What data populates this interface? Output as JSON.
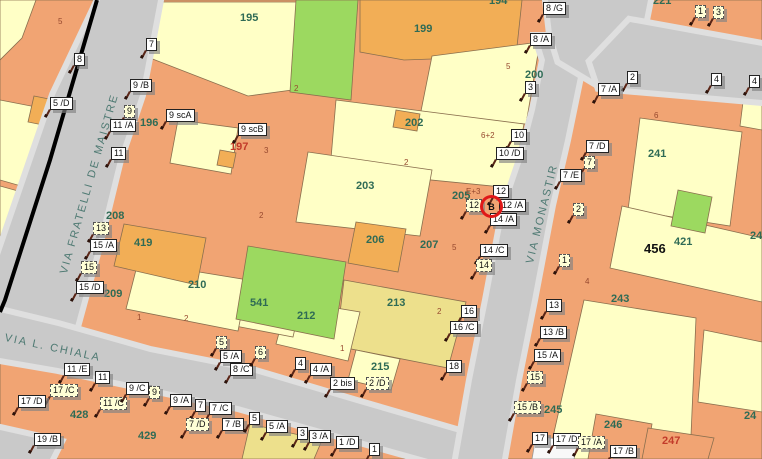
{
  "palette": {
    "parcel_salmon": "#F1A473",
    "parcel_pale_yellow": "#FFFFC6",
    "parcel_khaki": "#EDE08C",
    "parcel_green": "#9CD960",
    "building_orange": "#F2AE56",
    "road_gray": "#C9C9C9",
    "sidewalk_gray": "#E2E2E2",
    "parcel_number_green": "#2F6B55",
    "parcel_number_red": "#C23B2A",
    "annotation_brown": "#96482E",
    "street_name_color": "#4F7A73",
    "selection_red": "#E01818",
    "boundary_black": "#000000"
  },
  "streets": [
    {
      "name": "VIA FRATELLI DE MAISTRE"
    },
    {
      "name": "VIA L. CHIALA"
    },
    {
      "name": "VIA MONASTIR"
    }
  ],
  "selection": {
    "label": "B",
    "x": 480,
    "y": 195
  },
  "parcel_numbers": [
    {
      "n": "195",
      "x": 240,
      "y": 12
    },
    {
      "n": "194",
      "x": 489,
      "y": -5
    },
    {
      "n": "196",
      "x": 140,
      "y": 117
    },
    {
      "n": "197",
      "x": 230,
      "y": 141,
      "c": "red"
    },
    {
      "n": "199",
      "x": 414,
      "y": 23
    },
    {
      "n": "200",
      "x": 525,
      "y": 69
    },
    {
      "n": "202",
      "x": 405,
      "y": 117
    },
    {
      "n": "203",
      "x": 356,
      "y": 180
    },
    {
      "n": "205",
      "x": 452,
      "y": 190
    },
    {
      "n": "206",
      "x": 366,
      "y": 234
    },
    {
      "n": "207",
      "x": 420,
      "y": 239
    },
    {
      "n": "208",
      "x": 106,
      "y": 210
    },
    {
      "n": "209",
      "x": 104,
      "y": 288
    },
    {
      "n": "210",
      "x": 188,
      "y": 279
    },
    {
      "n": "212",
      "x": 297,
      "y": 310
    },
    {
      "n": "213",
      "x": 387,
      "y": 297
    },
    {
      "n": "215",
      "x": 371,
      "y": 361
    },
    {
      "n": "221",
      "x": 653,
      "y": -5
    },
    {
      "n": "241",
      "x": 648,
      "y": 148
    },
    {
      "n": "243",
      "x": 611,
      "y": 293
    },
    {
      "n": "245",
      "x": 544,
      "y": 404
    },
    {
      "n": "246",
      "x": 604,
      "y": 419
    },
    {
      "n": "247",
      "x": 662,
      "y": 435,
      "c": "red"
    },
    {
      "n": "419",
      "x": 134,
      "y": 237
    },
    {
      "n": "421",
      "x": 674,
      "y": 236
    },
    {
      "n": "428",
      "x": 70,
      "y": 409
    },
    {
      "n": "429",
      "x": 138,
      "y": 430
    },
    {
      "n": "456",
      "x": 644,
      "y": 241,
      "c": "black"
    },
    {
      "n": "541",
      "x": 250,
      "y": 297
    },
    {
      "n": "24",
      "x": 750,
      "y": 230
    },
    {
      "n": "24",
      "x": 744,
      "y": 410
    }
  ],
  "annotations": [
    {
      "t": "5",
      "x": 58,
      "y": 17
    },
    {
      "t": "2",
      "x": 294,
      "y": 84
    },
    {
      "t": "3",
      "x": 264,
      "y": 146
    },
    {
      "t": "2",
      "x": 404,
      "y": 158
    },
    {
      "t": "2",
      "x": 259,
      "y": 211
    },
    {
      "t": "5",
      "x": 452,
      "y": 243
    },
    {
      "t": "1",
      "x": 137,
      "y": 313
    },
    {
      "t": "2",
      "x": 184,
      "y": 314
    },
    {
      "t": "E+3",
      "x": 466,
      "y": 187
    },
    {
      "t": "6+2",
      "x": 481,
      "y": 131
    },
    {
      "t": "5",
      "x": 506,
      "y": 62
    },
    {
      "t": "6",
      "x": 654,
      "y": 111
    },
    {
      "t": "4",
      "x": 585,
      "y": 277
    },
    {
      "t": "2",
      "x": 437,
      "y": 307
    },
    {
      "t": "1",
      "x": 340,
      "y": 344
    }
  ],
  "civic_labels": [
    {
      "t": "8",
      "x": 74,
      "y": 53
    },
    {
      "t": "5 /D",
      "x": 50,
      "y": 97
    },
    {
      "t": "7",
      "x": 146,
      "y": 38
    },
    {
      "t": "9 /B",
      "x": 130,
      "y": 79
    },
    {
      "t": "9",
      "x": 124,
      "y": 105,
      "d": 1
    },
    {
      "t": "9 scA",
      "x": 166,
      "y": 109
    },
    {
      "t": "11 /A",
      "x": 110,
      "y": 119
    },
    {
      "t": "11",
      "x": 111,
      "y": 147
    },
    {
      "t": "13",
      "x": 93,
      "y": 222,
      "d": 1
    },
    {
      "t": "15 /A",
      "x": 90,
      "y": 239
    },
    {
      "t": "15",
      "x": 81,
      "y": 261,
      "d": 1
    },
    {
      "t": "15 /D",
      "x": 76,
      "y": 281
    },
    {
      "t": "9 scB",
      "x": 238,
      "y": 123
    },
    {
      "t": "5",
      "x": 216,
      "y": 336,
      "d": 1
    },
    {
      "t": "5 /A",
      "x": 220,
      "y": 350
    },
    {
      "t": "8 /C",
      "x": 230,
      "y": 363
    },
    {
      "t": "6",
      "x": 255,
      "y": 346,
      "d": 1
    },
    {
      "t": "4",
      "x": 295,
      "y": 357
    },
    {
      "t": "4 /A",
      "x": 310,
      "y": 363
    },
    {
      "t": "2 bis",
      "x": 330,
      "y": 377
    },
    {
      "t": "2 /D",
      "x": 366,
      "y": 377,
      "d": 1
    },
    {
      "t": "8 /G",
      "x": 543,
      "y": 2
    },
    {
      "t": "8 /A",
      "x": 530,
      "y": 33
    },
    {
      "t": "3",
      "x": 525,
      "y": 81
    },
    {
      "t": "10",
      "x": 511,
      "y": 129
    },
    {
      "t": "10 /D",
      "x": 496,
      "y": 147
    },
    {
      "t": "12",
      "x": 493,
      "y": 185
    },
    {
      "t": "12",
      "x": 466,
      "y": 199,
      "d": 1
    },
    {
      "t": "12 /A",
      "x": 499,
      "y": 199
    },
    {
      "t": "14 /A",
      "x": 490,
      "y": 213
    },
    {
      "t": "14 /C",
      "x": 480,
      "y": 244
    },
    {
      "t": "14",
      "x": 476,
      "y": 259,
      "d": 1
    },
    {
      "t": "16",
      "x": 461,
      "y": 305
    },
    {
      "t": "16 /C",
      "x": 450,
      "y": 321
    },
    {
      "t": "18",
      "x": 446,
      "y": 360
    },
    {
      "t": "2",
      "x": 627,
      "y": 71
    },
    {
      "t": "7 /A",
      "x": 598,
      "y": 83
    },
    {
      "t": "4",
      "x": 711,
      "y": 73
    },
    {
      "t": "4",
      "x": 749,
      "y": 75
    },
    {
      "t": "1",
      "x": 695,
      "y": 5,
      "d": 1
    },
    {
      "t": "3",
      "x": 713,
      "y": 6,
      "d": 1
    },
    {
      "t": "7 /D",
      "x": 586,
      "y": 140
    },
    {
      "t": "7",
      "x": 584,
      "y": 156,
      "d": 1
    },
    {
      "t": "7 /E",
      "x": 560,
      "y": 169
    },
    {
      "t": "2",
      "x": 573,
      "y": 203,
      "d": 1
    },
    {
      "t": "1",
      "x": 559,
      "y": 254,
      "d": 1
    },
    {
      "t": "13",
      "x": 546,
      "y": 299
    },
    {
      "t": "13 /B",
      "x": 540,
      "y": 326
    },
    {
      "t": "15 /A",
      "x": 534,
      "y": 349
    },
    {
      "t": "15",
      "x": 527,
      "y": 371,
      "d": 1
    },
    {
      "t": "15 /B",
      "x": 514,
      "y": 401,
      "d": 1
    },
    {
      "t": "17",
      "x": 532,
      "y": 432
    },
    {
      "t": "17 /D",
      "x": 553,
      "y": 433
    },
    {
      "t": "17 /A",
      "x": 578,
      "y": 436,
      "d": 1
    },
    {
      "t": "17 /B",
      "x": 610,
      "y": 445
    },
    {
      "t": "11 /E",
      "x": 64,
      "y": 363
    },
    {
      "t": "11",
      "x": 95,
      "y": 371
    },
    {
      "t": "17 /C",
      "x": 50,
      "y": 384,
      "d": 1
    },
    {
      "t": "17 /D",
      "x": 18,
      "y": 395
    },
    {
      "t": "11 /C",
      "x": 100,
      "y": 397,
      "d": 1
    },
    {
      "t": "9 /C",
      "x": 126,
      "y": 382
    },
    {
      "t": "9",
      "x": 149,
      "y": 386,
      "d": 1
    },
    {
      "t": "9 /A",
      "x": 170,
      "y": 394
    },
    {
      "t": "7",
      "x": 195,
      "y": 399
    },
    {
      "t": "7 /C",
      "x": 209,
      "y": 402
    },
    {
      "t": "7 /D",
      "x": 186,
      "y": 418,
      "d": 1
    },
    {
      "t": "7 /B",
      "x": 222,
      "y": 418
    },
    {
      "t": "5",
      "x": 249,
      "y": 412
    },
    {
      "t": "5 /A",
      "x": 266,
      "y": 420
    },
    {
      "t": "3",
      "x": 297,
      "y": 427
    },
    {
      "t": "3 /A",
      "x": 309,
      "y": 430
    },
    {
      "t": "1 /D",
      "x": 336,
      "y": 436
    },
    {
      "t": "1",
      "x": 369,
      "y": 443
    },
    {
      "t": "19 /B",
      "x": 34,
      "y": 433
    }
  ]
}
